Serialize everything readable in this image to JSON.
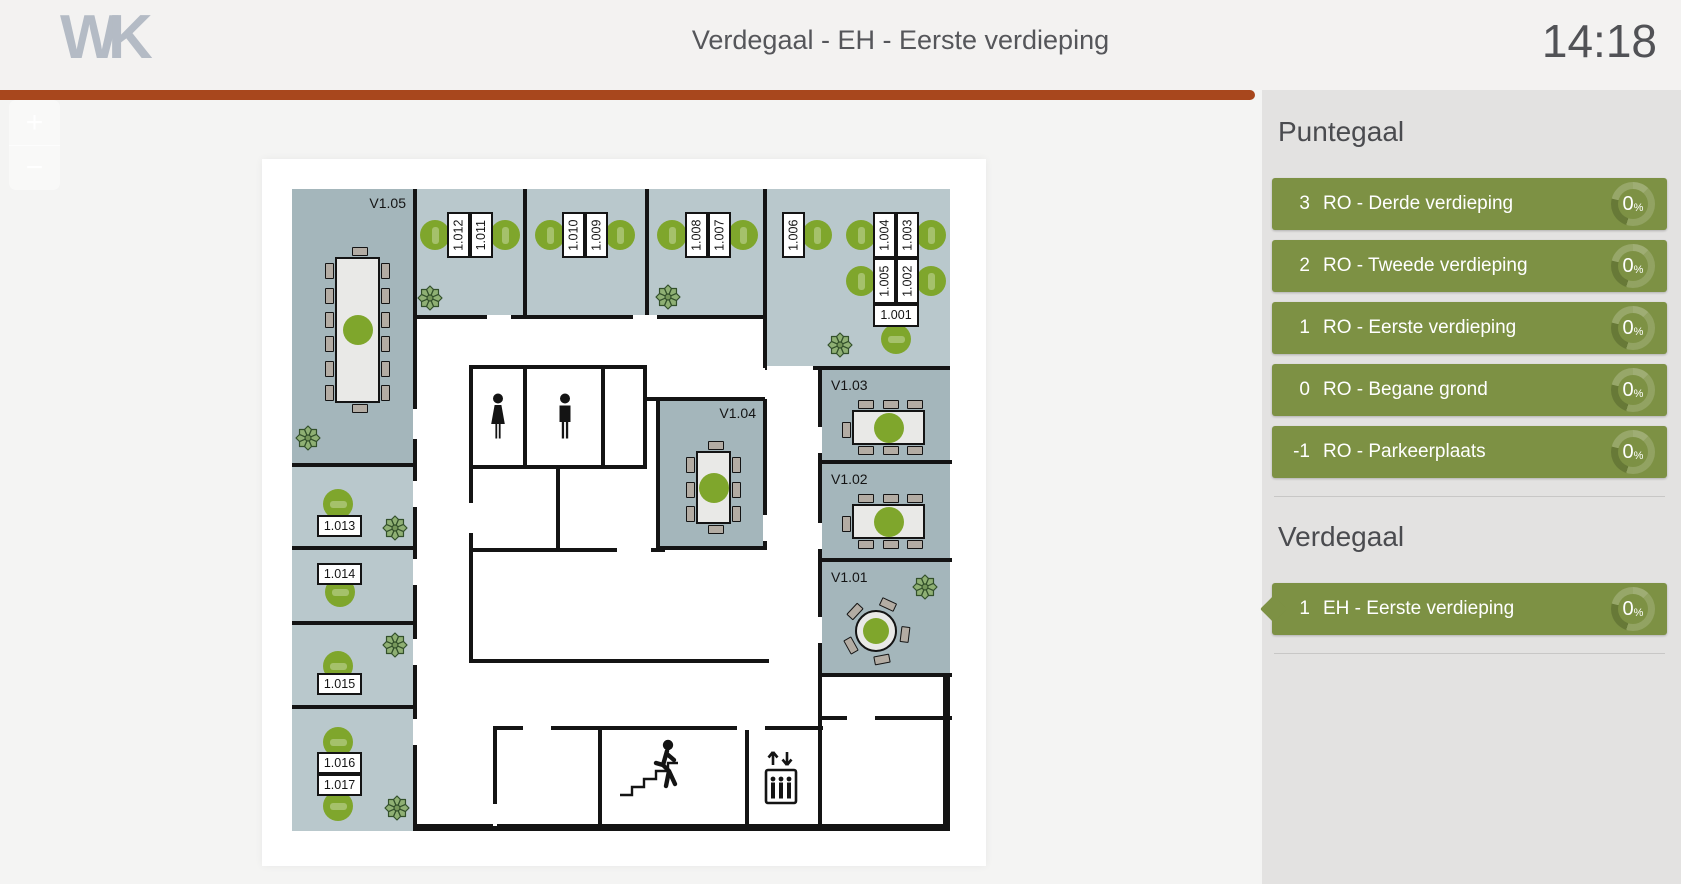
{
  "header": {
    "logo": "WK",
    "title": "Verdegaal - EH - Eerste verdieping",
    "clock": "14:18"
  },
  "zoom_controls": {
    "zoom_in": "+",
    "zoom_out": "−"
  },
  "sidebar": {
    "percent_suffix": "%",
    "sections": [
      {
        "title": "Puntegaal",
        "items": [
          {
            "number": "3",
            "label": "RO - Derde verdieping",
            "percent": "0",
            "active": false
          },
          {
            "number": "2",
            "label": "RO - Tweede verdieping",
            "percent": "0",
            "active": false
          },
          {
            "number": "1",
            "label": "RO - Eerste verdieping",
            "percent": "0",
            "active": false
          },
          {
            "number": "0",
            "label": "RO - Begane grond",
            "percent": "0",
            "active": false
          },
          {
            "number": "-1",
            "label": "RO - Parkeerplaats",
            "percent": "0",
            "active": false
          }
        ]
      },
      {
        "title": "Verdegaal",
        "items": [
          {
            "number": "1",
            "label": "EH - Eerste verdieping",
            "percent": "0",
            "active": true
          }
        ]
      }
    ]
  },
  "colors": {
    "accent_bar": "#A8471D",
    "tile_green": "#7D9144",
    "seat_green": "#7FA62C",
    "room_light": "#B9C8CC",
    "room_dark": "#A4B6BB",
    "wall": "#141414",
    "sidebar_bg": "#E3E2E1",
    "topbar_bg": "#F3F2F1",
    "page_bg": "#F4F4F3",
    "logo_gray": "#B4BBC5",
    "text_dark": "#515256"
  },
  "floorplan": {
    "rooms": [
      {
        "label": "V1.05",
        "lpos": "tr",
        "shade": "dark",
        "x": 30,
        "y": 30,
        "w": 123,
        "h": 276
      },
      {
        "label": "",
        "lpos": "",
        "shade": "light",
        "x": 153,
        "y": 30,
        "w": 110,
        "h": 128
      },
      {
        "label": "",
        "lpos": "",
        "shade": "light",
        "x": 263,
        "y": 30,
        "w": 122,
        "h": 128
      },
      {
        "label": "",
        "lpos": "",
        "shade": "light",
        "x": 385,
        "y": 30,
        "w": 118,
        "h": 128
      },
      {
        "label": "",
        "lpos": "",
        "shade": "light",
        "x": 503,
        "y": 30,
        "w": 185,
        "h": 179
      },
      {
        "label": "V1.04",
        "lpos": "tr",
        "shade": "dark",
        "x": 396,
        "y": 240,
        "w": 107,
        "h": 147
      },
      {
        "label": "V1.03",
        "lpos": "tl",
        "shade": "dark",
        "x": 558,
        "y": 211,
        "w": 130,
        "h": 90
      },
      {
        "label": "V1.02",
        "lpos": "tl",
        "shade": "dark",
        "x": 558,
        "y": 305,
        "w": 130,
        "h": 94
      },
      {
        "label": "V1.01",
        "lpos": "tl",
        "shade": "dark",
        "x": 558,
        "y": 403,
        "w": 130,
        "h": 111
      },
      {
        "label": "",
        "lpos": "",
        "shade": "light",
        "x": 30,
        "y": 306,
        "w": 123,
        "h": 81
      },
      {
        "label": "",
        "lpos": "",
        "shade": "light",
        "x": 30,
        "y": 389,
        "w": 123,
        "h": 73
      },
      {
        "label": "",
        "lpos": "",
        "shade": "light",
        "x": 30,
        "y": 464,
        "w": 123,
        "h": 82
      },
      {
        "label": "",
        "lpos": "",
        "shade": "light",
        "x": 30,
        "y": 548,
        "w": 123,
        "h": 124
      }
    ],
    "walls": [
      [
        151,
        30,
        4,
        642
      ],
      [
        261,
        30,
        4,
        128
      ],
      [
        383,
        30,
        4,
        128
      ],
      [
        501,
        30,
        4,
        179
      ],
      [
        151,
        156,
        352,
        4
      ],
      [
        503,
        207,
        185,
        4
      ],
      [
        556,
        207,
        4,
        311
      ],
      [
        556,
        301,
        134,
        4
      ],
      [
        556,
        399,
        134,
        4
      ],
      [
        556,
        514,
        134,
        4
      ],
      [
        556,
        514,
        4,
        158
      ],
      [
        30,
        304,
        123,
        4
      ],
      [
        30,
        387,
        123,
        4
      ],
      [
        30,
        462,
        123,
        4
      ],
      [
        30,
        546,
        123,
        4
      ],
      [
        207,
        206,
        176,
        4
      ],
      [
        207,
        206,
        4,
        104
      ],
      [
        261,
        206,
        4,
        104
      ],
      [
        339,
        206,
        4,
        104
      ],
      [
        381,
        206,
        4,
        104
      ],
      [
        207,
        306,
        178,
        4
      ],
      [
        294,
        306,
        4,
        85
      ],
      [
        207,
        306,
        4,
        198
      ],
      [
        207,
        389,
        196,
        4
      ],
      [
        383,
        238,
        120,
        4
      ],
      [
        394,
        240,
        4,
        151
      ],
      [
        501,
        240,
        4,
        151
      ],
      [
        394,
        387,
        111,
        4
      ],
      [
        207,
        500,
        300,
        4
      ],
      [
        231,
        567,
        330,
        4
      ],
      [
        231,
        567,
        4,
        105
      ],
      [
        336,
        567,
        4,
        105
      ],
      [
        483,
        567,
        4,
        105
      ],
      [
        556,
        557,
        134,
        4
      ]
    ],
    "door_gaps": [
      [
        151,
        250,
        4,
        30
      ],
      [
        151,
        322,
        4,
        26
      ],
      [
        151,
        400,
        4,
        26
      ],
      [
        151,
        480,
        4,
        26
      ],
      [
        151,
        560,
        4,
        26
      ],
      [
        225,
        156,
        24,
        4
      ],
      [
        371,
        156,
        24,
        4
      ],
      [
        505,
        207,
        46,
        4
      ],
      [
        556,
        268,
        4,
        26
      ],
      [
        556,
        364,
        4,
        26
      ],
      [
        556,
        458,
        4,
        26
      ],
      [
        207,
        344,
        4,
        30
      ],
      [
        355,
        389,
        34,
        4
      ],
      [
        501,
        356,
        4,
        26
      ],
      [
        261,
        567,
        28,
        4
      ],
      [
        475,
        567,
        28,
        4
      ],
      [
        231,
        645,
        4,
        22
      ],
      [
        585,
        557,
        28,
        4
      ]
    ],
    "desks": [
      {
        "label": "1.012",
        "x": 185,
        "y": 53,
        "w": 23,
        "h": 46,
        "rot": true
      },
      {
        "label": "1.011",
        "x": 208,
        "y": 53,
        "w": 23,
        "h": 46,
        "rot": true
      },
      {
        "label": "1.010",
        "x": 300,
        "y": 53,
        "w": 23,
        "h": 46,
        "rot": true
      },
      {
        "label": "1.009",
        "x": 323,
        "y": 53,
        "w": 23,
        "h": 46,
        "rot": true
      },
      {
        "label": "1.008",
        "x": 423,
        "y": 53,
        "w": 23,
        "h": 46,
        "rot": true
      },
      {
        "label": "1.007",
        "x": 446,
        "y": 53,
        "w": 23,
        "h": 46,
        "rot": true
      },
      {
        "label": "1.006",
        "x": 520,
        "y": 53,
        "w": 23,
        "h": 46,
        "rot": true
      },
      {
        "label": "1.004",
        "x": 611,
        "y": 53,
        "w": 23,
        "h": 46,
        "rot": true
      },
      {
        "label": "1.003",
        "x": 634,
        "y": 53,
        "w": 23,
        "h": 46,
        "rot": true
      },
      {
        "label": "1.005",
        "x": 611,
        "y": 99,
        "w": 23,
        "h": 46,
        "rot": true
      },
      {
        "label": "1.002",
        "x": 634,
        "y": 99,
        "w": 23,
        "h": 46,
        "rot": true
      },
      {
        "label": "1.001",
        "x": 611,
        "y": 145,
        "w": 46,
        "h": 23,
        "rot": false
      },
      {
        "label": "1.013",
        "x": 55,
        "y": 356,
        "w": 45,
        "h": 22,
        "rot": false
      },
      {
        "label": "1.014",
        "x": 55,
        "y": 404,
        "w": 45,
        "h": 22,
        "rot": false
      },
      {
        "label": "1.015",
        "x": 55,
        "y": 514,
        "w": 45,
        "h": 22,
        "rot": false
      },
      {
        "label": "1.016",
        "x": 55,
        "y": 593,
        "w": 45,
        "h": 22,
        "rot": false
      },
      {
        "label": "1.017",
        "x": 55,
        "y": 615,
        "w": 45,
        "h": 22,
        "rot": false
      }
    ],
    "seats": [
      {
        "cx": 173,
        "cy": 76,
        "slot": "v"
      },
      {
        "cx": 243,
        "cy": 76,
        "slot": "v"
      },
      {
        "cx": 288,
        "cy": 76,
        "slot": "v"
      },
      {
        "cx": 358,
        "cy": 76,
        "slot": "v"
      },
      {
        "cx": 410,
        "cy": 76,
        "slot": "v"
      },
      {
        "cx": 481,
        "cy": 76,
        "slot": "v"
      },
      {
        "cx": 555,
        "cy": 76,
        "slot": "v"
      },
      {
        "cx": 599,
        "cy": 76,
        "slot": "v"
      },
      {
        "cx": 669,
        "cy": 76,
        "slot": "v"
      },
      {
        "cx": 599,
        "cy": 122,
        "slot": "v"
      },
      {
        "cx": 669,
        "cy": 122,
        "slot": "v"
      },
      {
        "cx": 634,
        "cy": 180,
        "slot": "h"
      },
      {
        "cx": 76,
        "cy": 345,
        "slot": "h"
      },
      {
        "cx": 78,
        "cy": 433,
        "slot": "h"
      },
      {
        "cx": 76,
        "cy": 507,
        "slot": "h"
      },
      {
        "cx": 76,
        "cy": 583,
        "slot": "h"
      },
      {
        "cx": 76,
        "cy": 647,
        "slot": "h"
      }
    ],
    "tables": [
      {
        "type": "rect",
        "x": 73,
        "y": 98,
        "w": 45,
        "h": 146,
        "left": 6,
        "right": 6,
        "top": 1,
        "bottom": 1
      },
      {
        "type": "rect",
        "x": 434,
        "y": 292,
        "w": 35,
        "h": 73,
        "left": 3,
        "right": 3,
        "top": 1,
        "bottom": 1
      },
      {
        "type": "rect",
        "x": 590,
        "y": 251,
        "w": 73,
        "h": 35,
        "left": 1,
        "right": 0,
        "top": 3,
        "bottom": 3
      },
      {
        "type": "rect",
        "x": 590,
        "y": 345,
        "w": 73,
        "h": 35,
        "left": 1,
        "right": 0,
        "top": 3,
        "bottom": 3
      },
      {
        "type": "round",
        "cx": 614,
        "cy": 472,
        "r": 21,
        "chairs": 5
      }
    ],
    "plants": [
      {
        "x": 33,
        "y": 266
      },
      {
        "x": 155,
        "y": 126
      },
      {
        "x": 393,
        "y": 125
      },
      {
        "x": 565,
        "y": 173
      },
      {
        "x": 120,
        "y": 356
      },
      {
        "x": 120,
        "y": 473
      },
      {
        "x": 122,
        "y": 636
      },
      {
        "x": 650,
        "y": 415
      }
    ],
    "icons": [
      {
        "kind": "wc-woman",
        "x": 226,
        "y": 234
      },
      {
        "kind": "wc-man",
        "x": 293,
        "y": 234
      },
      {
        "kind": "stairs",
        "x": 356,
        "y": 578
      },
      {
        "kind": "elevator",
        "x": 501,
        "y": 589
      }
    ]
  }
}
